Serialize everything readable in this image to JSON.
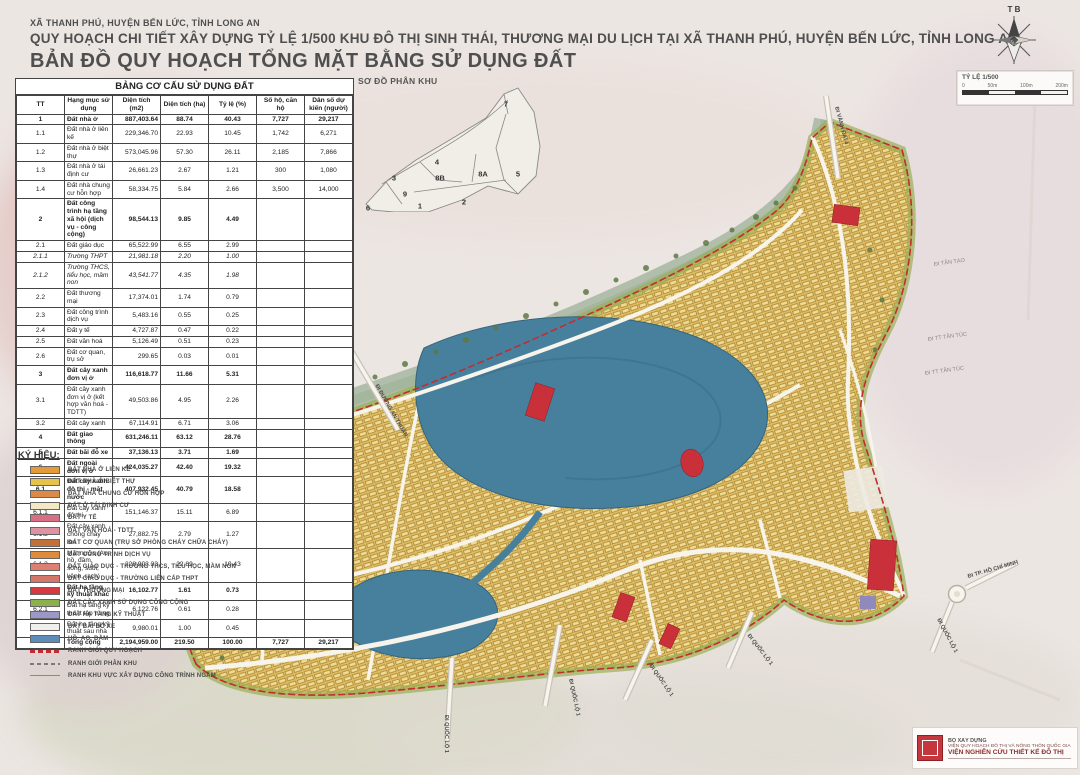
{
  "header": {
    "line1": "XÃ THANH PHÚ, HUYỆN BẾN LỨC, TỈNH LONG AN",
    "line2": "QUY HOẠCH CHI TIẾT XÂY DỰNG TỶ LỆ 1/500 KHU ĐÔ THỊ SINH THÁI, THƯƠNG MẠI DU LỊCH TẠI XÃ THANH PHÚ, HUYỆN BẾN LỨC, TỈNH LONG AN",
    "line3": "BẢN ĐỒ QUY HOẠCH TỔNG MẶT BẰNG SỬ DỤNG ĐẤT"
  },
  "compass": {
    "letters": "T B"
  },
  "scalebox": {
    "title": "TỶ LỆ 1/500",
    "ticks": [
      "0",
      "50m",
      "100m",
      "200m"
    ]
  },
  "table": {
    "title": "BẢNG CƠ CẤU SỬ DỤNG ĐẤT",
    "columns": [
      "TT",
      "Hạng mục sử dụng",
      "Diện tích (m2)",
      "Diện tích (ha)",
      "Tỷ lệ (%)",
      "Số hộ, căn hộ",
      "Dân số dự kiến (người)"
    ],
    "rows": [
      {
        "tt": "1",
        "name": "Đất nhà ở",
        "m2": "887,403.64",
        "ha": "88.74",
        "pct": "40.43",
        "units": "7,727",
        "pop": "29,217",
        "b": 1
      },
      {
        "tt": "1.1",
        "name": "Đất nhà ở liên kế",
        "m2": "229,346.70",
        "ha": "22.93",
        "pct": "10.45",
        "units": "1,742",
        "pop": "6,271"
      },
      {
        "tt": "1.2",
        "name": "Đất nhà ở biệt thự",
        "m2": "573,045.96",
        "ha": "57.30",
        "pct": "26.11",
        "units": "2,185",
        "pop": "7,866"
      },
      {
        "tt": "1.3",
        "name": "Đất nhà ở tái định cư",
        "m2": "26,661.23",
        "ha": "2.67",
        "pct": "1.21",
        "units": "300",
        "pop": "1,080"
      },
      {
        "tt": "1.4",
        "name": "Đất nhà chung cư hỗn hợp",
        "m2": "58,334.75",
        "ha": "5.84",
        "pct": "2.66",
        "units": "3,500",
        "pop": "14,000"
      },
      {
        "tt": "2",
        "name": "Đất công trình hạ tầng xã hội (dịch vụ - công cộng)",
        "m2": "98,544.13",
        "ha": "9.85",
        "pct": "4.49",
        "units": "",
        "pop": "",
        "b": 1
      },
      {
        "tt": "2.1",
        "name": "Đất giáo dục",
        "m2": "65,522.99",
        "ha": "6.55",
        "pct": "2.99",
        "units": "",
        "pop": ""
      },
      {
        "tt": "2.1.1",
        "name": "Trường THPT",
        "m2": "21,981.18",
        "ha": "2.20",
        "pct": "1.00",
        "units": "",
        "pop": "",
        "i": 1
      },
      {
        "tt": "2.1.2",
        "name": "Trường THCS, tiểu học, mầm non",
        "m2": "43,541.77",
        "ha": "4.35",
        "pct": "1.98",
        "units": "",
        "pop": "",
        "i": 1
      },
      {
        "tt": "2.2",
        "name": "Đất thương mại",
        "m2": "17,374.01",
        "ha": "1.74",
        "pct": "0.79",
        "units": "",
        "pop": ""
      },
      {
        "tt": "2.3",
        "name": "Đất công trình dịch vụ",
        "m2": "5,483.16",
        "ha": "0.55",
        "pct": "0.25",
        "units": "",
        "pop": ""
      },
      {
        "tt": "2.4",
        "name": "Đất y tế",
        "m2": "4,727.87",
        "ha": "0.47",
        "pct": "0.22",
        "units": "",
        "pop": ""
      },
      {
        "tt": "2.5",
        "name": "Đất văn hoá",
        "m2": "5,126.49",
        "ha": "0.51",
        "pct": "0.23",
        "units": "",
        "pop": ""
      },
      {
        "tt": "2.6",
        "name": "Đất cơ quan, trụ sở",
        "m2": "299.65",
        "ha": "0.03",
        "pct": "0.01",
        "units": "",
        "pop": ""
      },
      {
        "tt": "3",
        "name": "Đất cây xanh đơn vị ở",
        "m2": "116,618.77",
        "ha": "11.66",
        "pct": "5.31",
        "units": "",
        "pop": "",
        "b": 1
      },
      {
        "tt": "3.1",
        "name": "Đất cây xanh đơn vị ở (kết hợp văn hoá - TDTT)",
        "m2": "49,503.86",
        "ha": "4.95",
        "pct": "2.26",
        "units": "",
        "pop": ""
      },
      {
        "tt": "3.2",
        "name": "Đất cây xanh",
        "m2": "67,114.91",
        "ha": "6.71",
        "pct": "3.06",
        "units": "",
        "pop": ""
      },
      {
        "tt": "4",
        "name": "Đất giao thông",
        "m2": "631,246.11",
        "ha": "63.12",
        "pct": "28.76",
        "units": "",
        "pop": "",
        "b": 1
      },
      {
        "tt": "5",
        "name": "Đất bãi đỗ xe",
        "m2": "37,136.13",
        "ha": "3.71",
        "pct": "1.69",
        "units": "",
        "pop": "",
        "b": 1
      },
      {
        "tt": "6",
        "name": "Đất ngoài đơn vị ở",
        "m2": "424,035.27",
        "ha": "42.40",
        "pct": "19.32",
        "units": "",
        "pop": "",
        "b": 1
      },
      {
        "tt": "6.1",
        "name": "Đất cây xanh đô thị - mặt nước",
        "m2": "407,932.45",
        "ha": "40.79",
        "pct": "18.58",
        "units": "",
        "pop": "",
        "b": 1
      },
      {
        "tt": "6.1.1",
        "name": "Đất cây xanh đô thị",
        "m2": "151,146.37",
        "ha": "15.11",
        "pct": "6.89",
        "units": "",
        "pop": ""
      },
      {
        "tt": "6.1.2",
        "name": "Đất cây xanh chống cháy lan",
        "m2": "27,882.75",
        "ha": "2.79",
        "pct": "1.27",
        "units": "",
        "pop": ""
      },
      {
        "tt": "6.1.3",
        "name": "Mặt nước (Ao, hồ, đầm, sông, suối, kênh, rạch)",
        "m2": "228,903.33",
        "ha": "22.89",
        "pct": "10.43",
        "units": "",
        "pop": ""
      },
      {
        "tt": "6.2",
        "name": "Đất hạ tầng kỹ thuật khác",
        "m2": "16,102.77",
        "ha": "1.61",
        "pct": "0.73",
        "units": "",
        "pop": "",
        "b": 1
      },
      {
        "tt": "6.2.1",
        "name": "Đất hạ tầng kỹ thuật tập trung",
        "m2": "6,122.76",
        "ha": "0.61",
        "pct": "0.28",
        "units": "",
        "pop": ""
      },
      {
        "tt": "6.2.2",
        "name": "Đất hạ tầng kỹ thuật sau nhà",
        "m2": "9,980.01",
        "ha": "1.00",
        "pct": "0.45",
        "units": "",
        "pop": ""
      },
      {
        "tt": "",
        "name": "Tổng cộng",
        "m2": "2,194,959.00",
        "ha": "219.50",
        "pct": "100.00",
        "units": "7,727",
        "pop": "29,217",
        "b": 1
      }
    ]
  },
  "inset": {
    "title": "SƠ ĐỒ PHÂN KHU",
    "zones": [
      {
        "id": "1",
        "x": 62,
        "y": 120
      },
      {
        "id": "2",
        "x": 106,
        "y": 116
      },
      {
        "id": "3",
        "x": 36,
        "y": 92
      },
      {
        "id": "4",
        "x": 79,
        "y": 76
      },
      {
        "id": "5",
        "x": 160,
        "y": 88
      },
      {
        "id": "6",
        "x": 10,
        "y": 122
      },
      {
        "id": "7",
        "x": 148,
        "y": 18
      },
      {
        "id": "8A",
        "x": 125,
        "y": 88
      },
      {
        "id": "8B",
        "x": 82,
        "y": 92
      },
      {
        "id": "9",
        "x": 47,
        "y": 108
      }
    ]
  },
  "legend": {
    "title": "KÝ HIỆU:",
    "items": [
      {
        "label": "ĐẤT NHÀ Ở LIÊN KẾ",
        "type": "fill",
        "color": "#E39A3B"
      },
      {
        "label": "ĐẤT NHÀ Ở BIỆT THỰ",
        "type": "fill",
        "color": "#E6C34C"
      },
      {
        "label": "ĐẤT NHÀ CHUNG CƯ HỖN HỢP",
        "type": "fill",
        "color": "#DC8A45"
      },
      {
        "label": "ĐẤT Ở TÁI ĐỊNH CƯ",
        "type": "fill",
        "color": "#F4E7C3"
      },
      {
        "label": "ĐẤT Y TẾ",
        "type": "fill",
        "color": "#D96F85"
      },
      {
        "label": "ĐẤT VĂN HOÁ - TDTT",
        "type": "fill",
        "color": "#DE93A5"
      },
      {
        "label": "ĐẤT CƠ QUAN (TRỤ SỞ PHÒNG CHÁY CHỮA CHÁY)",
        "type": "fill",
        "color": "#C2703A"
      },
      {
        "label": "ĐẤT CÔNG TRÌNH DỊCH VỤ",
        "type": "fill",
        "color": "#E08A3C"
      },
      {
        "label": "ĐẤT GIÁO DỤC - TRƯỜNG THCS, TIỂU HỌC, MẦM NON",
        "type": "fill",
        "color": "#DD7F72"
      },
      {
        "label": "ĐẤT GIÁO DỤC - TRƯỜNG LIÊN CẤP THPT",
        "type": "fill",
        "color": "#D5766B"
      },
      {
        "label": "ĐẤT THƯƠNG MẠI",
        "type": "fill",
        "color": "#D63A40"
      },
      {
        "label": "ĐẤT CÂY XANH SỬ DỤNG CÔNG CỘNG",
        "type": "fill",
        "color": "#8CB04C"
      },
      {
        "label": "ĐẤT HẠ TẦNG KỸ THUẬT",
        "type": "fill",
        "color": "#9B97C6"
      },
      {
        "label": "ĐẤT BÃI ĐỖ XE",
        "type": "fill",
        "color": "#EFEFEC"
      },
      {
        "label": "HỒ, AO, ĐẦM",
        "type": "fill",
        "color": "#5C8CB8"
      },
      {
        "label": "RANH GIỚI QUY HOẠCH",
        "type": "line-red-dash",
        "color": "#C42B33"
      },
      {
        "label": "RANH GIỚI PHÂN KHU",
        "type": "line-gray-dash",
        "color": "#7a7a7a"
      },
      {
        "label": "RANH KHU VỰC XÂY DỰNG CÔNG TRÌNH NGẦM",
        "type": "line-thin",
        "color": "#888888"
      }
    ]
  },
  "map_labels": [
    {
      "text": "ĐI VÀNH ĐAI 4",
      "x": 836,
      "y": 104,
      "rot": 75,
      "cls": ""
    },
    {
      "text": "ĐI ĐƯỜNG AN THUẬN",
      "x": 376,
      "y": 382,
      "rot": 60,
      "cls": ""
    },
    {
      "text": "ĐI TÂN TẠO",
      "x": 934,
      "y": 262,
      "rot": -8,
      "cls": "faint"
    },
    {
      "text": "ĐI TT TÂN TÚC",
      "x": 928,
      "y": 337,
      "rot": -8,
      "cls": "faint"
    },
    {
      "text": "ĐI TT TÂN TÚC",
      "x": 925,
      "y": 371,
      "rot": -8,
      "cls": "faint"
    },
    {
      "text": "ĐI TP. HỒ CHÍ MINH",
      "x": 968,
      "y": 574,
      "rot": -16,
      "cls": ""
    },
    {
      "text": "ĐI QUỐC LỘ 1",
      "x": 938,
      "y": 616,
      "rot": 62,
      "cls": ""
    },
    {
      "text": "ĐI QUỐC LỘ 1",
      "x": 446,
      "y": 712,
      "rot": 90,
      "cls": ""
    },
    {
      "text": "ĐI QUỐC LỘ 1",
      "x": 570,
      "y": 676,
      "rot": 78,
      "cls": ""
    },
    {
      "text": "ĐI QUỐC LỘ 1",
      "x": 650,
      "y": 662,
      "rot": 55,
      "cls": ""
    },
    {
      "text": "ĐI QUỐC LỘ 1",
      "x": 748,
      "y": 632,
      "rot": 52,
      "cls": ""
    }
  ],
  "credits": {
    "line1": "BỘ XÂY DỰNG",
    "line2": "VIỆN QUY HOẠCH ĐÔ THỊ VÀ NÔNG THÔN QUỐC GIA",
    "line3": "VIỆN NGHIÊN CỨU THIẾT KẾ ĐÔ THỊ"
  },
  "map_colors": {
    "estate_base": "#E3BC5F",
    "lake": "#47809D",
    "boundary": "#C42B33",
    "river": "#AEBCA8",
    "green_edge": "#9AAF54",
    "commercial_red": "#C9303A"
  }
}
